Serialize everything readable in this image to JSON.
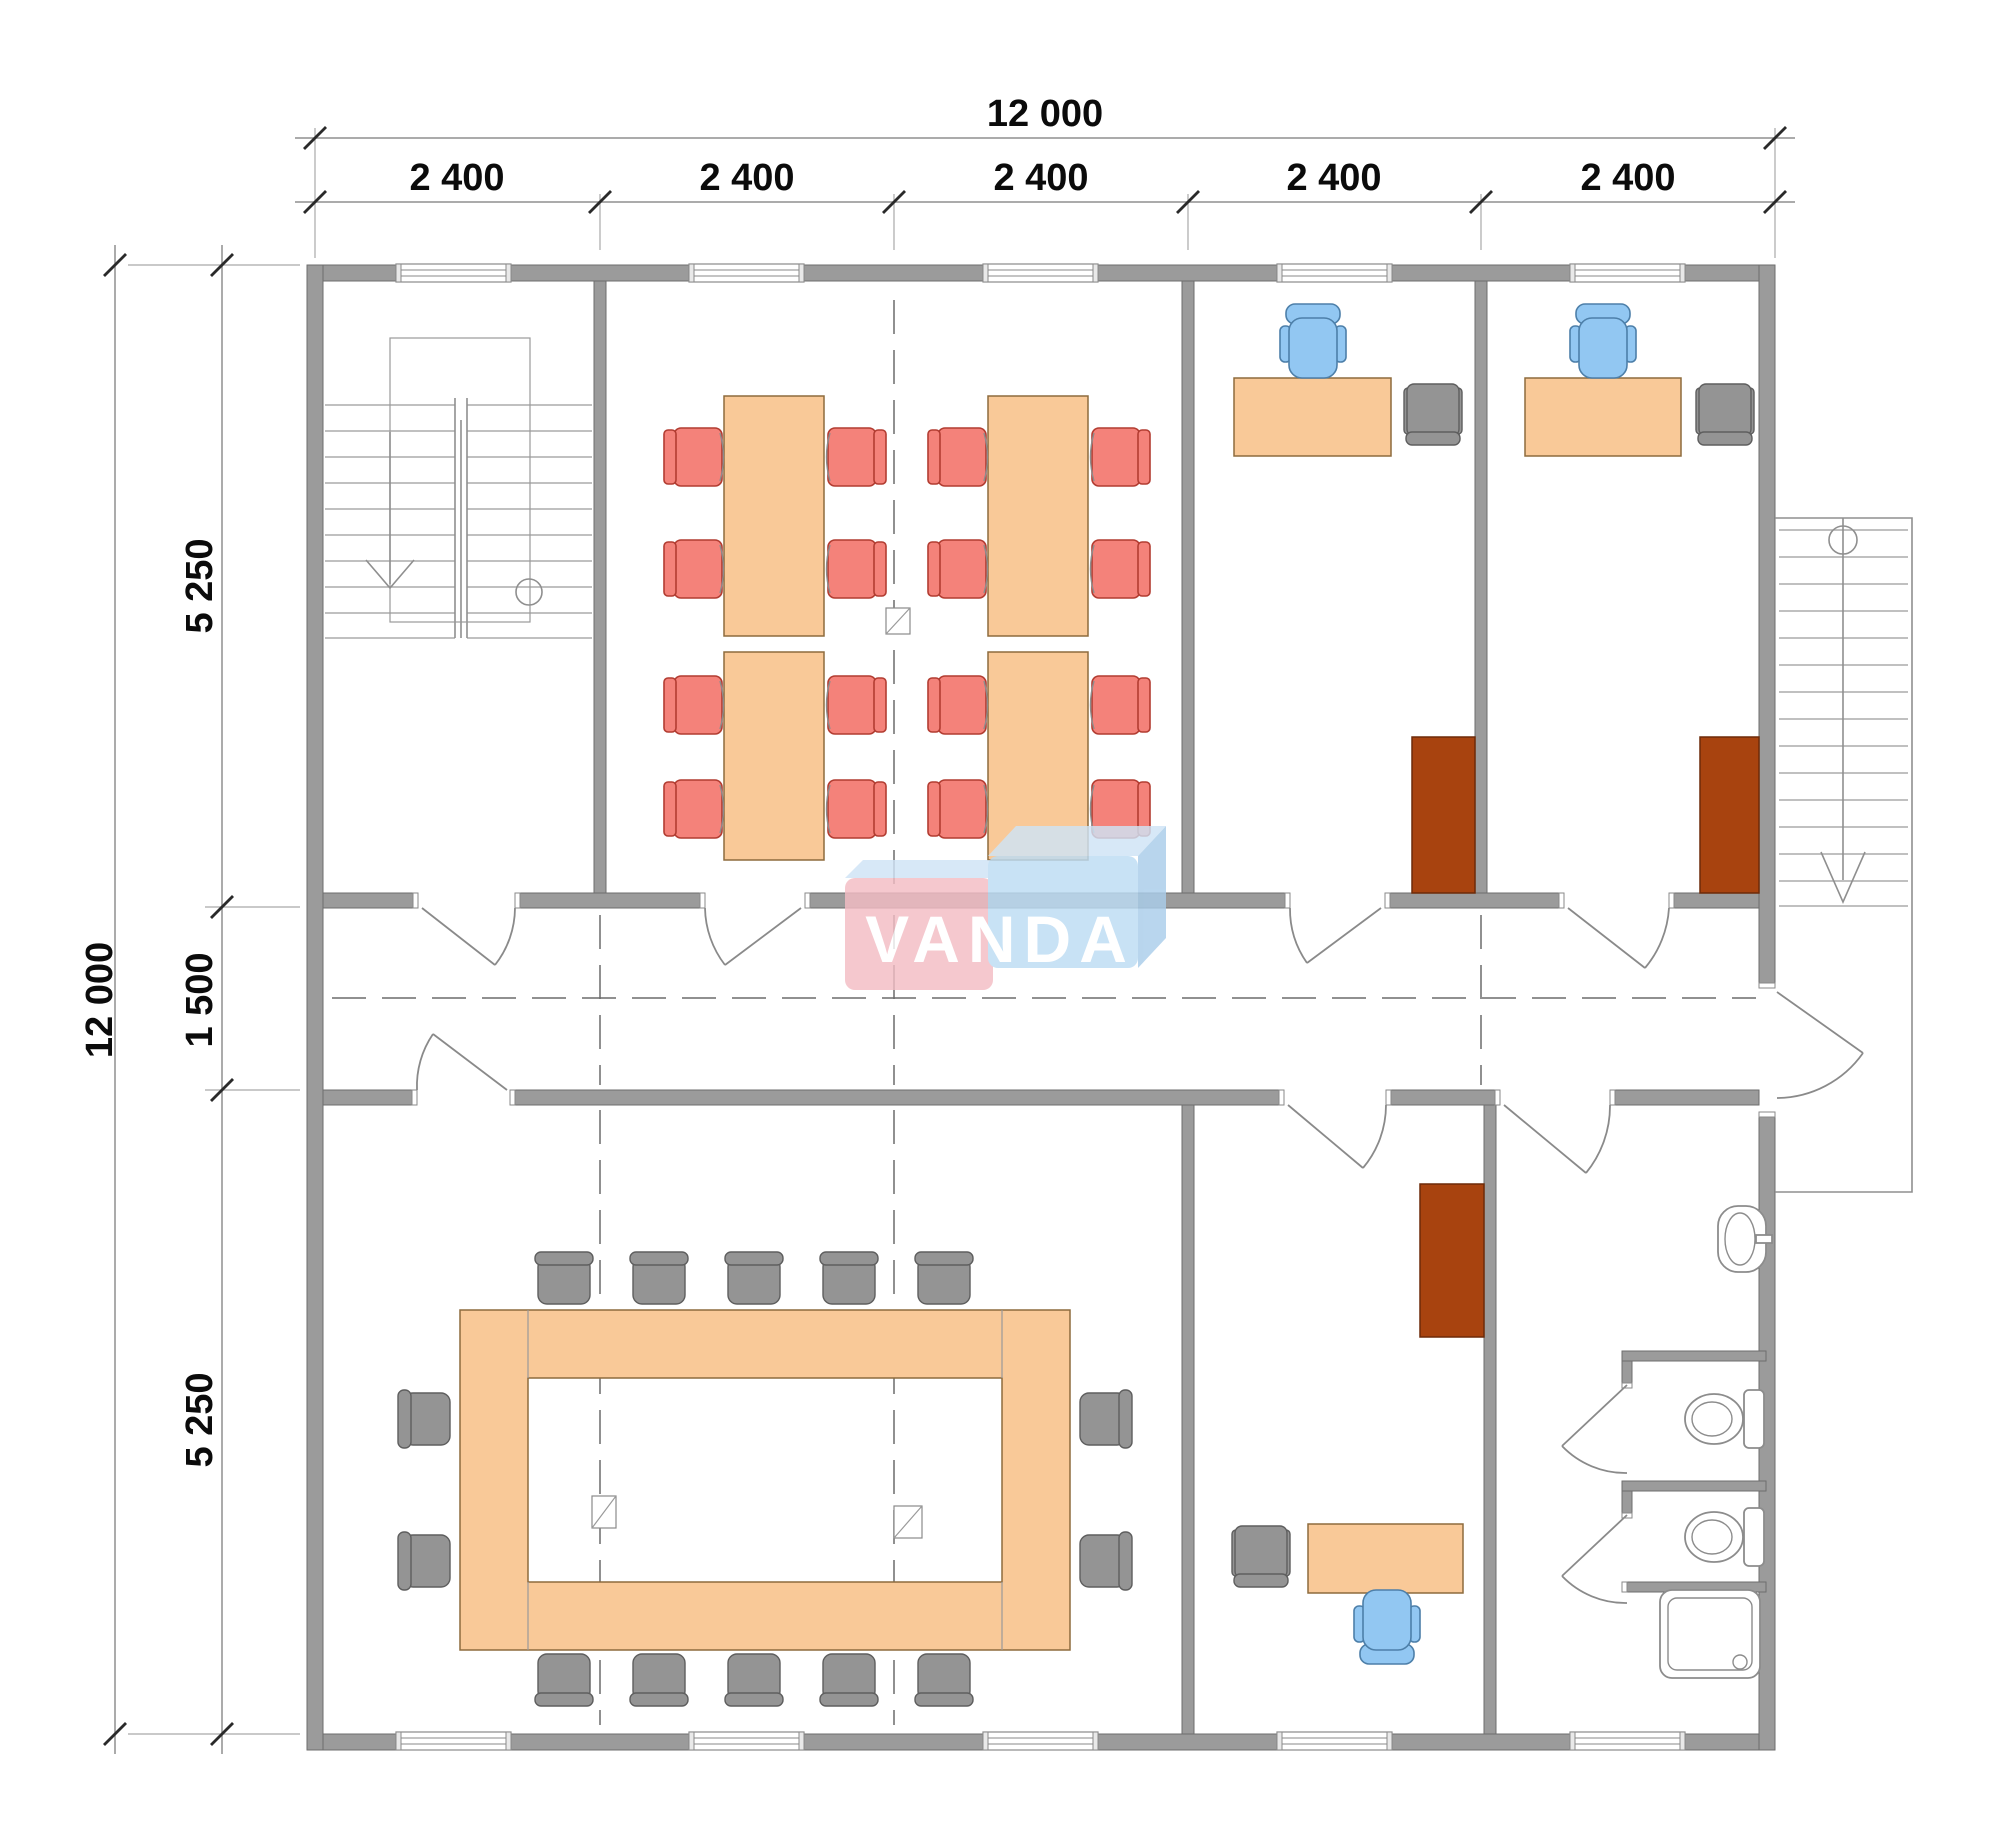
{
  "watermark": {
    "text": "VANDA"
  },
  "dimensions": {
    "horizontal": {
      "total": "12 000",
      "segments": [
        "2 400",
        "2 400",
        "2 400",
        "2 400",
        "2 400"
      ]
    },
    "vertical": {
      "total": "12 000",
      "segments": [
        "5 250",
        "1 500",
        "5 250"
      ]
    }
  },
  "colors": {
    "wall": "#9b9b9b",
    "wood": "#f9c998",
    "chair-red": "#f4827a",
    "chair-red-stroke": "#b23c31",
    "chair-blue": "#92c7f2",
    "chair-blue-stroke": "#4d7fa9",
    "chair-gray": "#949494",
    "chair-gray-stroke": "#5e5e5e",
    "cabinet": "#a8430f",
    "watermark-pink": "#f3bcc4",
    "watermark-blue": "#bcdcf4",
    "watermark-text": "#ffffff"
  }
}
